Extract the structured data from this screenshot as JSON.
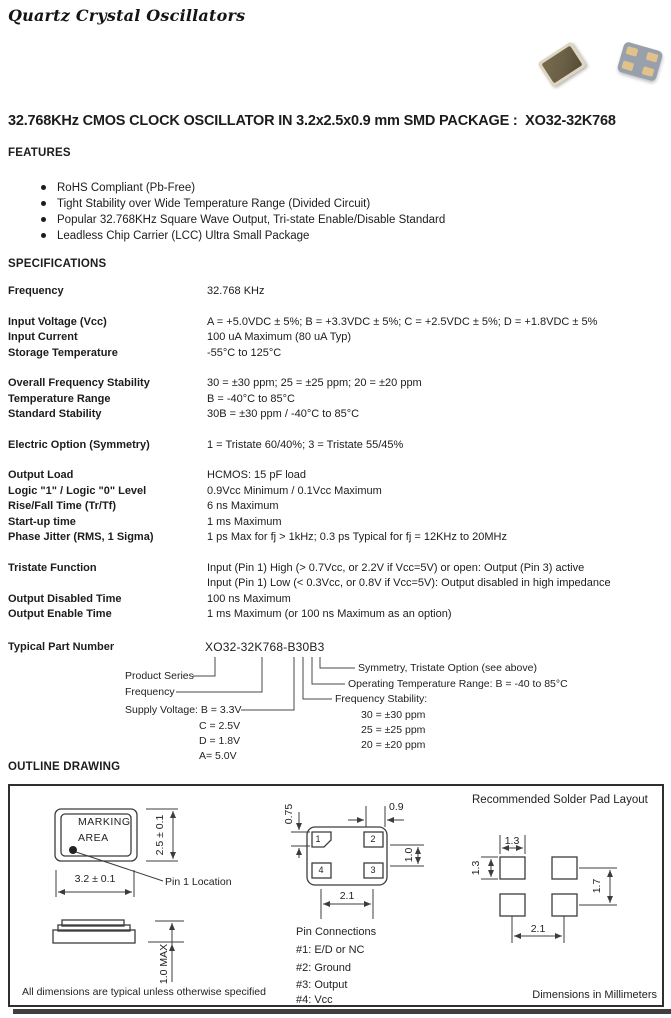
{
  "page": {
    "brand_title": "Quartz Crystal Oscillators",
    "main_title": "32.768KHz CMOS CLOCK OSCILLATOR IN 3.2x2.5x0.9 mm SMD PACKAGE :  XO32-32K768"
  },
  "package_photos": {
    "top_view_body_color": "#ded6c3",
    "top_view_lid_color": "#6a5f45",
    "bottom_view_body_color": "#98a0ac",
    "bottom_view_pad_color": "#e2c28b"
  },
  "features": {
    "heading": "FEATURES",
    "items": [
      "RoHS Compliant (Pb-Free)",
      "Tight Stability over Wide Temperature Range (Divided Circuit)",
      "Popular 32.768KHz Square Wave Output, Tri-state Enable/Disable Standard",
      "Leadless Chip Carrier (LCC) Ultra Small Package"
    ]
  },
  "specifications": {
    "heading": "SPECIFICATIONS",
    "rows": [
      {
        "label": "Frequency",
        "value": "32.768 KHz"
      },
      {
        "label": "Input Voltage (Vcc)",
        "value": "A = +5.0VDC ± 5%; B = +3.3VDC ± 5%; C = +2.5VDC ± 5%; D = +1.8VDC ± 5%"
      },
      {
        "label": "Input Current",
        "value": "100 uA Maximum (80 uA Typ)"
      },
      {
        "label": "Storage Temperature",
        "value": "-55°C to 125°C"
      },
      {
        "label": "Overall Frequency Stability",
        "value": "30 = ±30 ppm;  25 = ±25 ppm;  20 = ±20 ppm"
      },
      {
        "label": "Temperature Range",
        "value": "B = -40°C to 85°C"
      },
      {
        "label": "Standard Stability",
        "value": "30B = ±30 ppm / -40°C to 85°C"
      },
      {
        "label": "Electric Option (Symmetry)",
        "value": "1 = Tristate 60/40%; 3 = Tristate 55/45%"
      },
      {
        "label": "Output Load",
        "value": "HCMOS: 15 pF load"
      },
      {
        "label": "Logic \"1\" / Logic \"0\" Level",
        "value": "0.9Vcc Minimum / 0.1Vcc Maximum"
      },
      {
        "label": "Rise/Fall Time (Tr/Tf)",
        "value": "6 ns Maximum"
      },
      {
        "label": "Start-up time",
        "value": "1 ms Maximum"
      },
      {
        "label": "Phase Jitter (RMS, 1 Sigma)",
        "value": "1 ps Max for fj > 1kHz;  0.3 ps Typical for fj = 12KHz to 20MHz"
      },
      {
        "label": "Tristate Function",
        "value": "Input (Pin 1) High (> 0.7Vcc, or 2.2V if Vcc=5V) or open: Output (Pin 3) active\nInput (Pin 1) Low (< 0.3Vcc, or 0.8V if Vcc=5V): Output disabled in high impedance"
      },
      {
        "label": "Output Disabled Time",
        "value": "100 ns Maximum"
      },
      {
        "label": "Output Enable Time",
        "value": "1 ms Maximum (or 100 ns Maximum as an option)"
      }
    ]
  },
  "part_number": {
    "label": "Typical Part Number",
    "value": "XO32-32K768-B30B3",
    "product_series": "Product Series",
    "frequency": "Frequency",
    "supply_voltage": "Supply Voltage: B = 3.3V",
    "supply_options": [
      "C = 2.5V",
      "D = 1.8V",
      "A= 5.0V"
    ],
    "stability_header": "Frequency Stability:",
    "stability_options": [
      "30 = ±30 ppm",
      "25 = ±25 ppm",
      "20 = ±20 ppm"
    ],
    "op_temp": "Operating Temperature Range: B = -40 to 85°C",
    "symmetry": "Symmetry, Tristate Option (see above)"
  },
  "outline": {
    "heading": "OUTLINE DRAWING",
    "marking_line1": "MARKING",
    "marking_line2": "AREA",
    "dim_width": "3.2 ± 0.1",
    "dim_height": "2.5 ± 0.1",
    "dim_thickness": "1.0 MAX",
    "pin1_location": "Pin 1 Location",
    "pads": {
      "p1": "1",
      "p2": "2",
      "p3": "3",
      "p4": "4"
    },
    "bottom_view_dims": {
      "pad_height": "0.75",
      "pad_width": "0.9",
      "row_gap": "1.0",
      "pitch": "2.1"
    },
    "pin_connections": {
      "heading": "Pin Connections",
      "items": [
        "#1: E/D or NC",
        "#2: Ground",
        "#3: Output",
        "#4: Vcc"
      ]
    },
    "solder_pad": {
      "title": "Recommended Solder Pad Layout",
      "dim_pad_w": "1.3",
      "dim_pad_h": "1.3",
      "dim_vertical": "1.7",
      "dim_pitch": "2.1"
    },
    "note_left": "All dimensions are typical unless otherwise specified",
    "note_right": "Dimensions in Millimeters"
  }
}
